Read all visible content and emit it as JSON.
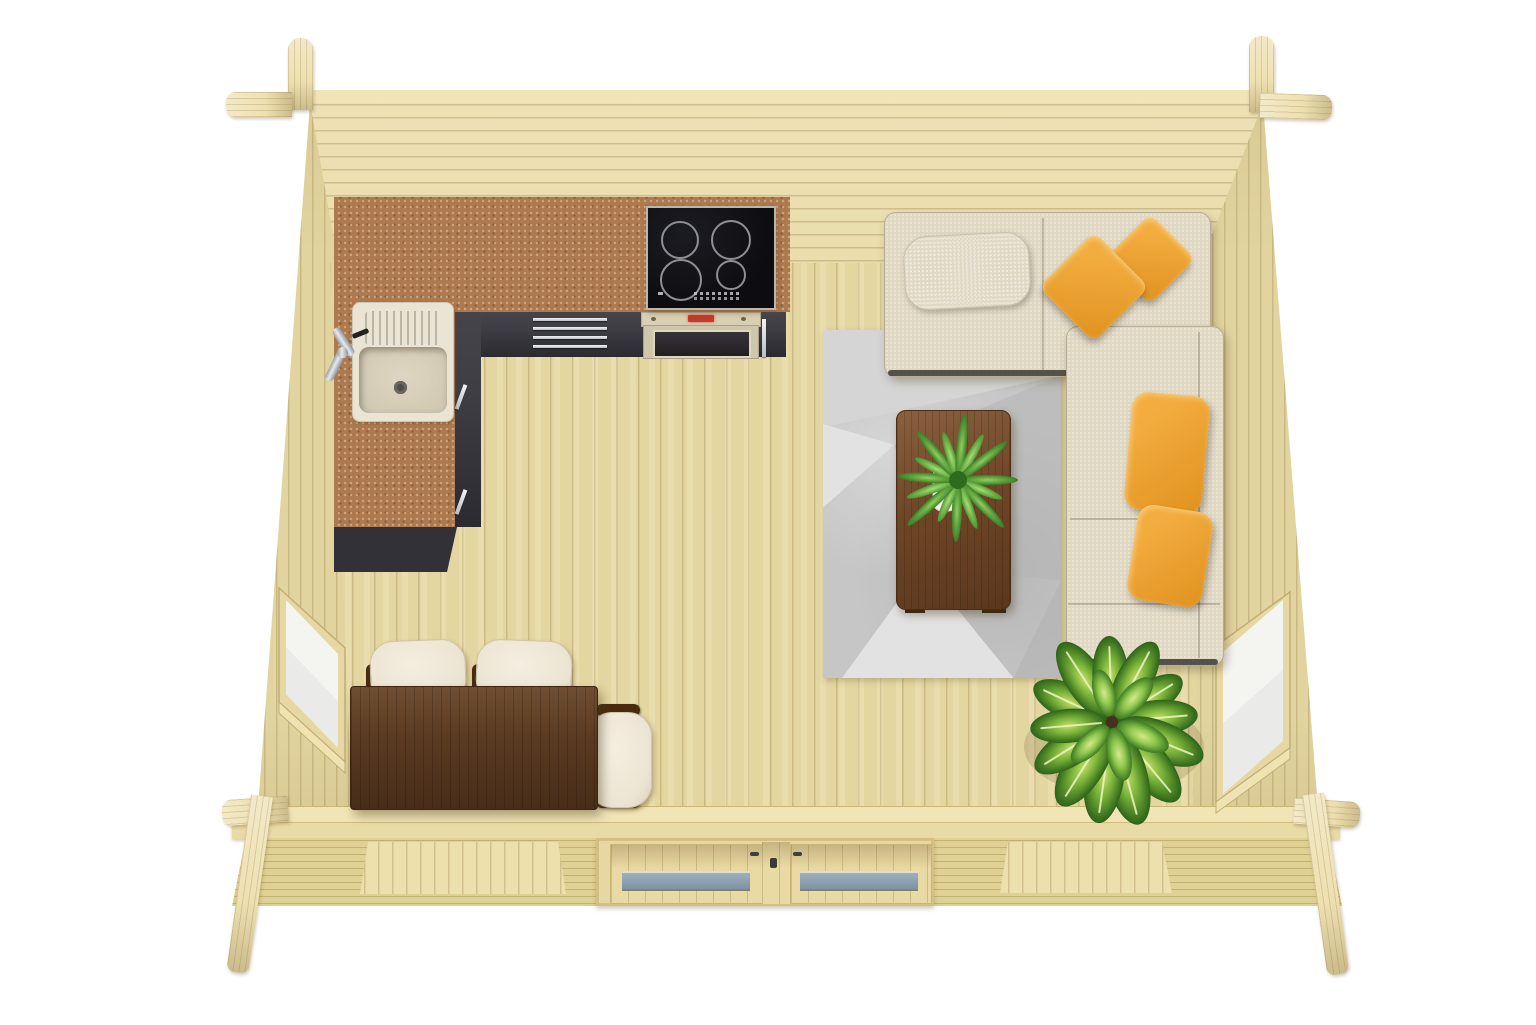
{
  "scene": {
    "description": "Photorealistic top-down 3D render of a wooden log cabin garden house interior with kitchen corner, lounge corner sofa and dining set",
    "view": "bird's-eye with slight perspective",
    "background": "white"
  },
  "colors": {
    "bg": "#ffffff",
    "wood_top_edge": "#f1e4b6",
    "wood_wall": "#e9daa6",
    "wood_wall_side": "#e2d49e",
    "wood_floor": "#e4d6a0",
    "plate1": "#f2e5b5",
    "plate2": "#e9dba6",
    "outer": "#dfd093",
    "recess": "#eee0ac",
    "frame": "#e7d7a2",
    "counter": "#ad7a50",
    "cabinet": "#3e3d44",
    "cabinet_dark": "#2b2a31",
    "cooktop": "#0d0d11",
    "ring": "#8f9094",
    "oven_band": "#d8cfb4",
    "oven_frame": "#cfc6ab",
    "oven_glass": "#221f23",
    "display": "#c43a2c",
    "sink": "#eae4d4",
    "basin": "#ded6c2",
    "drain": "#514e46",
    "sofa": "#e0d8c3",
    "sofa_base": "#3a3935",
    "pillow": "#ece5d3",
    "yellow": "#f3ad3f",
    "yellow_deep": "#e0921f",
    "rug": "#c6c6c6",
    "rug_light": "#d5d5d5",
    "rug_lighter": "#e2e2e2",
    "rug_dark": "#b3b3b3",
    "walnut": "#6f4627",
    "walnut_dark": "#4c2d14",
    "dining": "#5b3b22",
    "chair": "#ece4d2",
    "chair_arm": "#4a2b12",
    "glass_door_1": "#9db0c0",
    "glass_door_2": "#7e93a4",
    "glass_win": "#f4f4f0",
    "glass_win_shade": "#e7e9e6",
    "leaf_dark": "#2d6319",
    "leaf_mid": "#7ab33a",
    "leaf_light": "#c2dd6a",
    "leaf_stripe": "#eef5c0",
    "fern_dark": "#3c7e26",
    "fern_light": "#8ed05e",
    "pot": "#f4f2ec",
    "soil": "#46301d"
  },
  "cabin": {
    "structure": "interlocking pine logs with crossed corner joints",
    "windows": [
      "left wall window",
      "right wall window",
      "front wall window left",
      "front wall window right"
    ],
    "door": "front double door with glazing",
    "floor": "vertical pine planks"
  },
  "kitchen": {
    "counter": "L-shaped terracotta stone worktop",
    "cabinet_fronts": "anthracite drawers with steel handles",
    "cooktop_zones": 4,
    "appliances": [
      "induction cooktop",
      "built-in oven"
    ],
    "fixtures": [
      "granite composite sink",
      "chrome faucet"
    ]
  },
  "living": {
    "sofa": "cream corner sofa with chaise",
    "cushions": {
      "cream_pillow": 1,
      "yellow_pillows": 2,
      "yellow_bolsters": 2
    },
    "rug": "grey geometric area rug",
    "coffee_table": "walnut rectangular coffee table",
    "plants": [
      "fern in white pot on table",
      "dieffenbachia in white planter on floor"
    ]
  },
  "dining": {
    "table": "dark walnut rectangular table",
    "chairs": 3
  }
}
